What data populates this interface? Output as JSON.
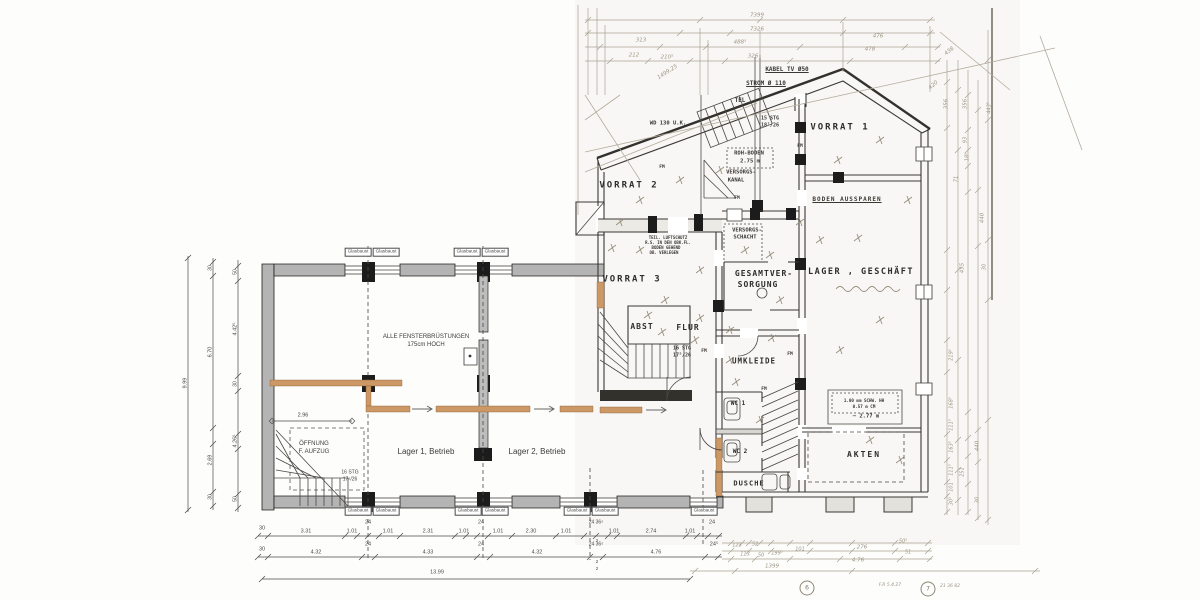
{
  "drawing": {
    "type": "architectural floor plan (German)",
    "sheet_marks": [
      "6",
      "7"
    ]
  },
  "colors": {
    "paper": "#fdfdfc",
    "scan_tint": "#f5f3ee",
    "wall_gray": "#b4b4b4",
    "ink": "#3a3833",
    "pencil": "#b3ab9c",
    "accent_tan": "#cc9866"
  },
  "rooms": [
    {
      "t": "VORRAT 1",
      "x": 840,
      "y": 128,
      "fs": 9,
      "ls": 2
    },
    {
      "t": "VORRAT 2",
      "x": 629,
      "y": 186,
      "fs": 9,
      "ls": 2
    },
    {
      "t": "VORRAT 3",
      "x": 632,
      "y": 280,
      "fs": 9,
      "ls": 2
    },
    {
      "t": "LAGER , GESCHÄFT",
      "x": 861,
      "y": 272,
      "fs": 8.5,
      "ls": 1.5
    },
    {
      "t": "GESAMTVER-",
      "x": 764,
      "y": 274,
      "fs": 8,
      "ls": 1
    },
    {
      "t": "SORGUNG",
      "x": 758,
      "y": 285,
      "fs": 8,
      "ls": 1
    },
    {
      "t": "ABST",
      "x": 642,
      "y": 327,
      "fs": 8,
      "ls": 1
    },
    {
      "t": "FLUR",
      "x": 688,
      "y": 328,
      "fs": 8,
      "ls": 1
    },
    {
      "t": "UMKLEIDE",
      "x": 754,
      "y": 361,
      "fs": 7.5,
      "ls": 1
    },
    {
      "t": "WC 1",
      "x": 738,
      "y": 404,
      "fs": 6
    },
    {
      "t": "WC 2",
      "x": 740,
      "y": 452,
      "fs": 6
    },
    {
      "t": "DUSCHE",
      "x": 749,
      "y": 484,
      "fs": 7,
      "ls": 1
    },
    {
      "t": "AKTEN",
      "x": 864,
      "y": 455,
      "fs": 8,
      "ls": 2
    }
  ],
  "cad_texts": [
    {
      "t": "ALLE FENSTERBRÜSTUNGEN",
      "x": 426,
      "y": 337,
      "fs": 6
    },
    {
      "t": "175cm HOCH",
      "x": 426,
      "y": 345,
      "fs": 6
    },
    {
      "t": "Lager 1, Betrieb",
      "x": 426,
      "y": 452,
      "fs": 8
    },
    {
      "t": "Lager 2, Betrieb",
      "x": 537,
      "y": 452,
      "fs": 8
    },
    {
      "t": "ÖFFNUNG",
      "x": 314,
      "y": 444,
      "fs": 6
    },
    {
      "t": "F. AUFZUG",
      "x": 314,
      "y": 452,
      "fs": 6
    },
    {
      "t": "16 STG",
      "x": 350,
      "y": 473,
      "fs": 5
    },
    {
      "t": "17⁵/26",
      "x": 350,
      "y": 480,
      "fs": 5
    },
    {
      "t": "2.96",
      "x": 303,
      "y": 416,
      "fs": 5.5
    }
  ],
  "annotations": [
    {
      "t": "VERSORGS-",
      "x": 747,
      "y": 231,
      "fs": 5.5
    },
    {
      "t": "SCHACHT",
      "x": 745,
      "y": 238,
      "fs": 5.5
    },
    {
      "t": "VERSORGS-",
      "x": 741,
      "y": 173,
      "fs": 5.5
    },
    {
      "t": "KANAL",
      "x": 736,
      "y": 181,
      "fs": 5.5
    },
    {
      "t": "ROH-BODEN",
      "x": 749,
      "y": 154,
      "fs": 5.5
    },
    {
      "t": "2.75 m",
      "x": 750,
      "y": 162,
      "fs": 5.5
    },
    {
      "t": "BODEN AUSSPAREN",
      "x": 847,
      "y": 200,
      "fs": 6,
      "ls": 1,
      "u": true
    },
    {
      "t": "KABEL TV Ø50",
      "x": 787,
      "y": 70,
      "fs": 6,
      "u": true
    },
    {
      "t": "STROM Ø 110",
      "x": 766,
      "y": 84,
      "fs": 6,
      "u": true
    },
    {
      "t": "TEL",
      "x": 740,
      "y": 101,
      "fs": 6
    },
    {
      "t": "WD 130 U.K.",
      "x": 668,
      "y": 124,
      "fs": 5.5
    },
    {
      "t": "15 STG",
      "x": 770,
      "y": 119,
      "fs": 5
    },
    {
      "t": "18⁷/26",
      "x": 770,
      "y": 126,
      "fs": 5
    },
    {
      "t": "16 STG",
      "x": 682,
      "y": 349,
      "fs": 5
    },
    {
      "t": "17⁵/26",
      "x": 682,
      "y": 356,
      "fs": 5
    },
    {
      "t": "1.00 mm SCHW. HH",
      "x": 864,
      "y": 401,
      "fs": 4.2
    },
    {
      "t": "0.57 m CM",
      "x": 864,
      "y": 407,
      "fs": 4.2
    },
    {
      "t": "— 2.77 m",
      "x": 866,
      "y": 417,
      "fs": 5.5
    },
    {
      "t": "TEIL. LUFTSCHUTZ",
      "x": 668,
      "y": 238,
      "fs": 4
    },
    {
      "t": "R.S. IN DEN OBK.FL.",
      "x": 668,
      "y": 243,
      "fs": 4
    },
    {
      "t": "BODEN GEHEND",
      "x": 666,
      "y": 248,
      "fs": 4
    },
    {
      "t": "OB. VERLEGEN",
      "x": 664,
      "y": 253,
      "fs": 4
    },
    {
      "t": "FM",
      "x": 662,
      "y": 168,
      "fs": 4.5
    },
    {
      "t": "FM",
      "x": 737,
      "y": 199,
      "fs": 4.5
    },
    {
      "t": "FM",
      "x": 800,
      "y": 147,
      "fs": 4.5
    },
    {
      "t": "FM",
      "x": 704,
      "y": 352,
      "fs": 4.5
    },
    {
      "t": "FM",
      "x": 790,
      "y": 355,
      "fs": 4.5
    },
    {
      "t": "FM",
      "x": 764,
      "y": 390,
      "fs": 4.5
    }
  ],
  "dimensions": [
    {
      "t": "30",
      "x": 262,
      "y": 529,
      "fs": 5.5
    },
    {
      "t": "3.31",
      "x": 306,
      "y": 532,
      "fs": 5.5
    },
    {
      "t": "1.01",
      "x": 352,
      "y": 532,
      "fs": 5.5
    },
    {
      "t": "24",
      "x": 368,
      "y": 523,
      "fs": 5.5
    },
    {
      "t": "1.01",
      "x": 388,
      "y": 532,
      "fs": 5.5
    },
    {
      "t": "2.31",
      "x": 428,
      "y": 532,
      "fs": 5.5
    },
    {
      "t": "1.01",
      "x": 464,
      "y": 532,
      "fs": 5.5
    },
    {
      "t": "24",
      "x": 481,
      "y": 523,
      "fs": 5.5
    },
    {
      "t": "1.01",
      "x": 498,
      "y": 532,
      "fs": 5.5
    },
    {
      "t": "2.30",
      "x": 531,
      "y": 532,
      "fs": 5.5
    },
    {
      "t": "1.01",
      "x": 566,
      "y": 532,
      "fs": 5.5
    },
    {
      "t": "24 36⁵",
      "x": 596,
      "y": 523,
      "fs": 5
    },
    {
      "t": "2",
      "x": 597,
      "y": 541,
      "fs": 4.5
    },
    {
      "t": "1.01",
      "x": 614,
      "y": 532,
      "fs": 5.5
    },
    {
      "t": "2.74",
      "x": 651,
      "y": 532,
      "fs": 5.5
    },
    {
      "t": "1.01",
      "x": 690,
      "y": 532,
      "fs": 5.5
    },
    {
      "t": "24",
      "x": 712,
      "y": 523,
      "fs": 5.5
    },
    {
      "t": "30",
      "x": 262,
      "y": 550,
      "fs": 5.5
    },
    {
      "t": "4.32",
      "x": 316,
      "y": 553,
      "fs": 5.5
    },
    {
      "t": "24",
      "x": 368,
      "y": 545,
      "fs": 5.5
    },
    {
      "t": "4.33",
      "x": 428,
      "y": 553,
      "fs": 5.5
    },
    {
      "t": "24",
      "x": 481,
      "y": 545,
      "fs": 5.5
    },
    {
      "t": "4.32",
      "x": 537,
      "y": 553,
      "fs": 5.5
    },
    {
      "t": "24 36⁵",
      "x": 596,
      "y": 545,
      "fs": 5
    },
    {
      "t": "2",
      "x": 597,
      "y": 562,
      "fs": 4.5
    },
    {
      "t": "2",
      "x": 597,
      "y": 569,
      "fs": 4.5
    },
    {
      "t": "4.76",
      "x": 656,
      "y": 553,
      "fs": 5.5
    },
    {
      "t": "24⁵",
      "x": 714,
      "y": 545,
      "fs": 5.5
    },
    {
      "t": "13.99",
      "x": 437,
      "y": 573,
      "fs": 5.5
    },
    {
      "t": "9.99",
      "x": 186,
      "y": 383,
      "fs": 5.5,
      "r": -90
    },
    {
      "t": "30",
      "x": 211,
      "y": 268,
      "fs": 5,
      "r": -90
    },
    {
      "t": "6.70",
      "x": 211,
      "y": 352,
      "fs": 5.5,
      "r": -90
    },
    {
      "t": "2.69",
      "x": 211,
      "y": 460,
      "fs": 5.5,
      "r": -90
    },
    {
      "t": "30",
      "x": 211,
      "y": 497,
      "fs": 5,
      "r": -90
    },
    {
      "t": "50",
      "x": 236,
      "y": 272,
      "fs": 5,
      "r": -90
    },
    {
      "t": "4.42⁵",
      "x": 236,
      "y": 329,
      "fs": 5.5,
      "r": -90
    },
    {
      "t": "30",
      "x": 236,
      "y": 384,
      "fs": 5,
      "r": -90
    },
    {
      "t": "4.26⁵",
      "x": 236,
      "y": 441,
      "fs": 5.5,
      "r": -90
    },
    {
      "t": "50",
      "x": 236,
      "y": 499,
      "fs": 5,
      "r": -90
    }
  ],
  "windows": [
    {
      "t": "Glasbaust",
      "x": 358,
      "y": 252,
      "fs": 4.6
    },
    {
      "t": "Glasbaust",
      "x": 386,
      "y": 252,
      "fs": 4.6
    },
    {
      "t": "Glasbaust",
      "x": 467,
      "y": 252,
      "fs": 4.6
    },
    {
      "t": "Glasbaust",
      "x": 495,
      "y": 252,
      "fs": 4.6
    },
    {
      "t": "Glasbaust",
      "x": 358,
      "y": 511,
      "fs": 4.6
    },
    {
      "t": "Glasbaust",
      "x": 386,
      "y": 511,
      "fs": 4.6
    },
    {
      "t": "Glasbaust",
      "x": 468,
      "y": 511,
      "fs": 4.6
    },
    {
      "t": "Glasbaust",
      "x": 495,
      "y": 511,
      "fs": 4.6
    },
    {
      "t": "Glasbaust",
      "x": 577,
      "y": 511,
      "fs": 4.6
    },
    {
      "t": "Glasbaust",
      "x": 605,
      "y": 511,
      "fs": 4.6
    },
    {
      "t": "Glasbaust",
      "x": 704,
      "y": 511,
      "fs": 4.6
    }
  ],
  "pencil": [
    {
      "t": "7399",
      "x": 757,
      "y": 16,
      "fs": 5.5
    },
    {
      "t": "7326",
      "x": 757,
      "y": 30,
      "fs": 5.5
    },
    {
      "t": "313",
      "x": 641,
      "y": 41,
      "fs": 5.5
    },
    {
      "t": "488⁵",
      "x": 740,
      "y": 43,
      "fs": 5.5
    },
    {
      "t": "476",
      "x": 878,
      "y": 37,
      "fs": 5.5
    },
    {
      "t": "212",
      "x": 634,
      "y": 56,
      "fs": 5.5
    },
    {
      "t": "210⁵",
      "x": 667,
      "y": 58,
      "fs": 5.5
    },
    {
      "t": "326",
      "x": 753,
      "y": 57,
      "fs": 5.5
    },
    {
      "t": "478",
      "x": 870,
      "y": 50,
      "fs": 5.5
    },
    {
      "t": "436",
      "x": 950,
      "y": 52,
      "fs": 5.5,
      "r": -38
    },
    {
      "t": "1499,25",
      "x": 668,
      "y": 73,
      "fs": 5.5,
      "r": -33
    },
    {
      "t": "420",
      "x": 934,
      "y": 86,
      "fs": 5.5,
      "r": -40
    },
    {
      "t": "356",
      "x": 947,
      "y": 104,
      "fs": 5.5,
      "r": -90
    },
    {
      "t": "356",
      "x": 966,
      "y": 104,
      "fs": 5.5,
      "r": -90
    },
    {
      "t": "443⁵",
      "x": 990,
      "y": 108,
      "fs": 5,
      "r": -90
    },
    {
      "t": "93",
      "x": 966,
      "y": 140,
      "fs": 5,
      "r": -90
    },
    {
      "t": "18⁵",
      "x": 968,
      "y": 157,
      "fs": 5,
      "r": -90
    },
    {
      "t": "71",
      "x": 957,
      "y": 179,
      "fs": 5,
      "r": -90
    },
    {
      "t": "440",
      "x": 983,
      "y": 218,
      "fs": 5.5,
      "r": -90
    },
    {
      "t": "455",
      "x": 963,
      "y": 268,
      "fs": 5.5,
      "r": -90
    },
    {
      "t": "30",
      "x": 985,
      "y": 267,
      "fs": 5,
      "r": -90
    },
    {
      "t": "219⁵",
      "x": 952,
      "y": 355,
      "fs": 5,
      "r": -90
    },
    {
      "t": "168⁵",
      "x": 952,
      "y": 403,
      "fs": 5,
      "r": -90
    },
    {
      "t": "111⁵",
      "x": 952,
      "y": 425,
      "fs": 5,
      "r": -90
    },
    {
      "t": "163⁵",
      "x": 952,
      "y": 447,
      "fs": 5,
      "r": -90
    },
    {
      "t": "111⁵",
      "x": 952,
      "y": 470,
      "fs": 5,
      "r": -90
    },
    {
      "t": "251",
      "x": 963,
      "y": 472,
      "fs": 5,
      "r": -90
    },
    {
      "t": "101",
      "x": 952,
      "y": 487,
      "fs": 5,
      "r": -90
    },
    {
      "t": "30⁵",
      "x": 952,
      "y": 501,
      "fs": 5,
      "r": -90
    },
    {
      "t": "440",
      "x": 978,
      "y": 446,
      "fs": 5.5,
      "r": -90
    },
    {
      "t": "30",
      "x": 978,
      "y": 500,
      "fs": 5,
      "r": -90
    },
    {
      "t": "1399",
      "x": 772,
      "y": 567,
      "fs": 5.5
    },
    {
      "t": "4.76",
      "x": 858,
      "y": 561,
      "fs": 5.5
    },
    {
      "t": "276",
      "x": 862,
      "y": 548,
      "fs": 5.5
    },
    {
      "t": "51",
      "x": 908,
      "y": 553,
      "fs": 5
    },
    {
      "t": "50⁵",
      "x": 903,
      "y": 542,
      "fs": 5
    },
    {
      "t": "123",
      "x": 737,
      "y": 546,
      "fs": 5
    },
    {
      "t": "52",
      "x": 755,
      "y": 545,
      "fs": 5
    },
    {
      "t": "113",
      "x": 745,
      "y": 555,
      "fs": 5
    },
    {
      "t": "50",
      "x": 761,
      "y": 556,
      "fs": 5
    },
    {
      "t": "199⁵",
      "x": 777,
      "y": 554,
      "fs": 5
    },
    {
      "t": "101",
      "x": 800,
      "y": 550,
      "fs": 5
    },
    {
      "t": "F.R 5.4.27",
      "x": 890,
      "y": 586,
      "fs": 4.5
    },
    {
      "t": "21 36 82",
      "x": 950,
      "y": 587,
      "fs": 4.5
    }
  ],
  "sheet_marks": [
    {
      "t": "6",
      "x": 807,
      "y": 588,
      "fs": 6,
      "circ": true
    },
    {
      "t": "7",
      "x": 928,
      "y": 589,
      "fs": 6,
      "circ": true
    }
  ]
}
